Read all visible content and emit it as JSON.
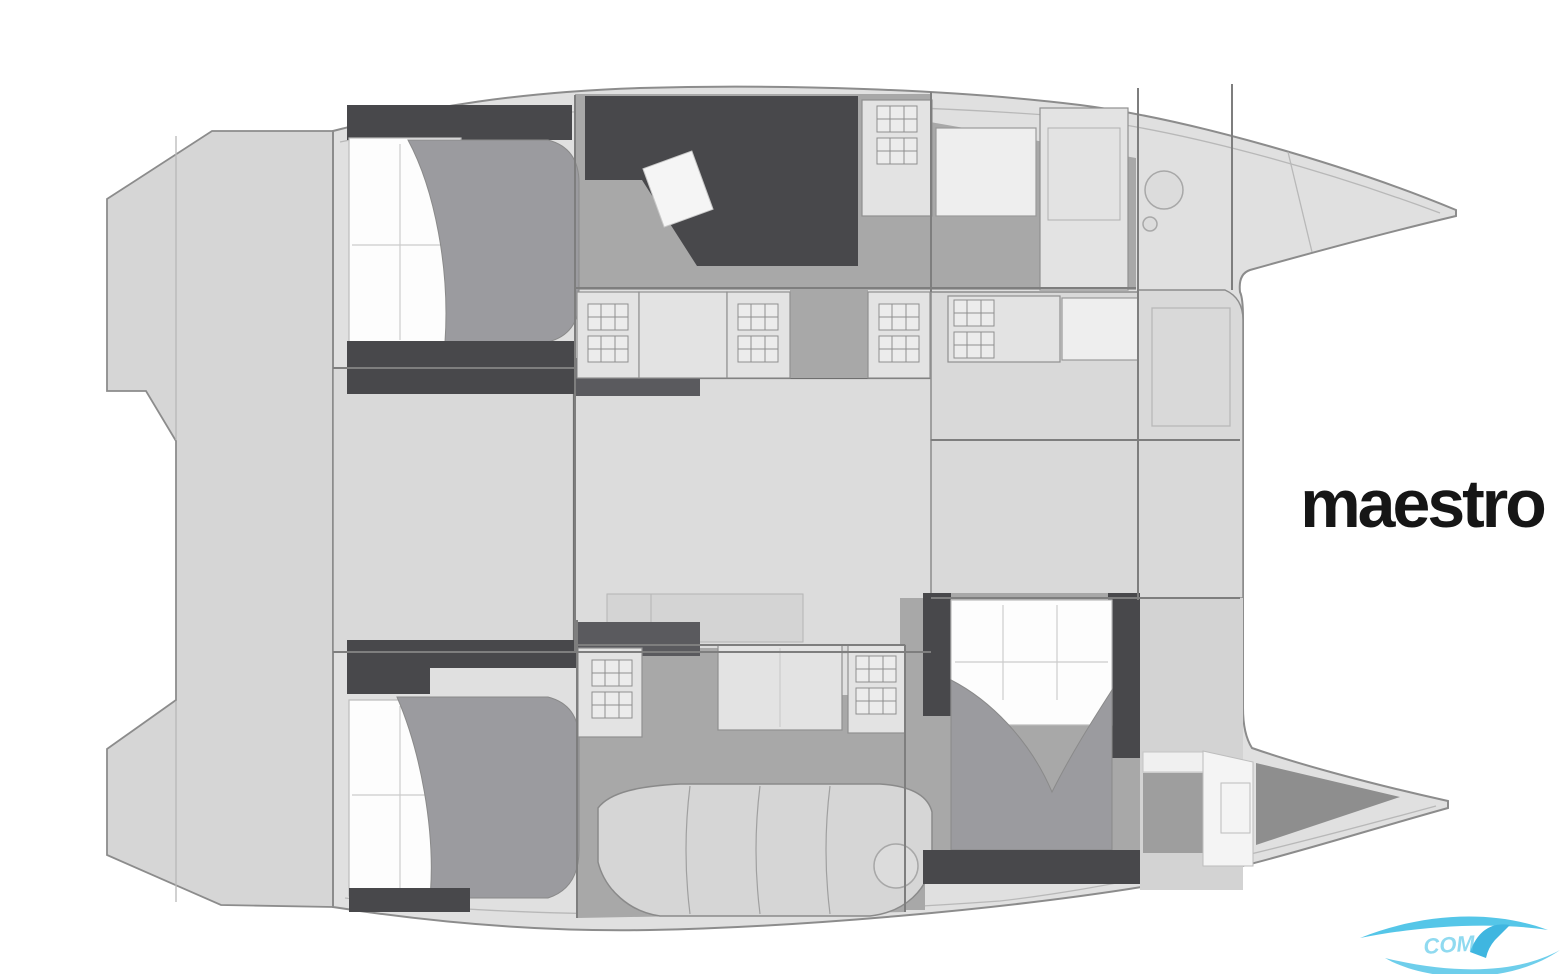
{
  "title": {
    "label": "maestro"
  },
  "watermark": {
    "text": "COM"
  },
  "diagram": {
    "type": "catamaran-floorplan"
  },
  "palette": {
    "page_bg": "#ffffff",
    "hull_fill": "#e0e0e0",
    "transom_fill": "#d6d6d6",
    "panel_fill": "#d9d9d9",
    "saloon_fill": "#dcdcdc",
    "module_fill": "#e3e3e3",
    "floor_gray": "#a8a8a8",
    "wall_dark": "#48484b",
    "wall_mid": "#5a5a5e",
    "bed_white": "#fdfdfd",
    "duvet_gray": "#9b9b9f",
    "outline": "#8c8c8c",
    "title_color": "#161616",
    "logo_blue": "#55c6e8",
    "logo_fin": "#3fb6e0"
  }
}
